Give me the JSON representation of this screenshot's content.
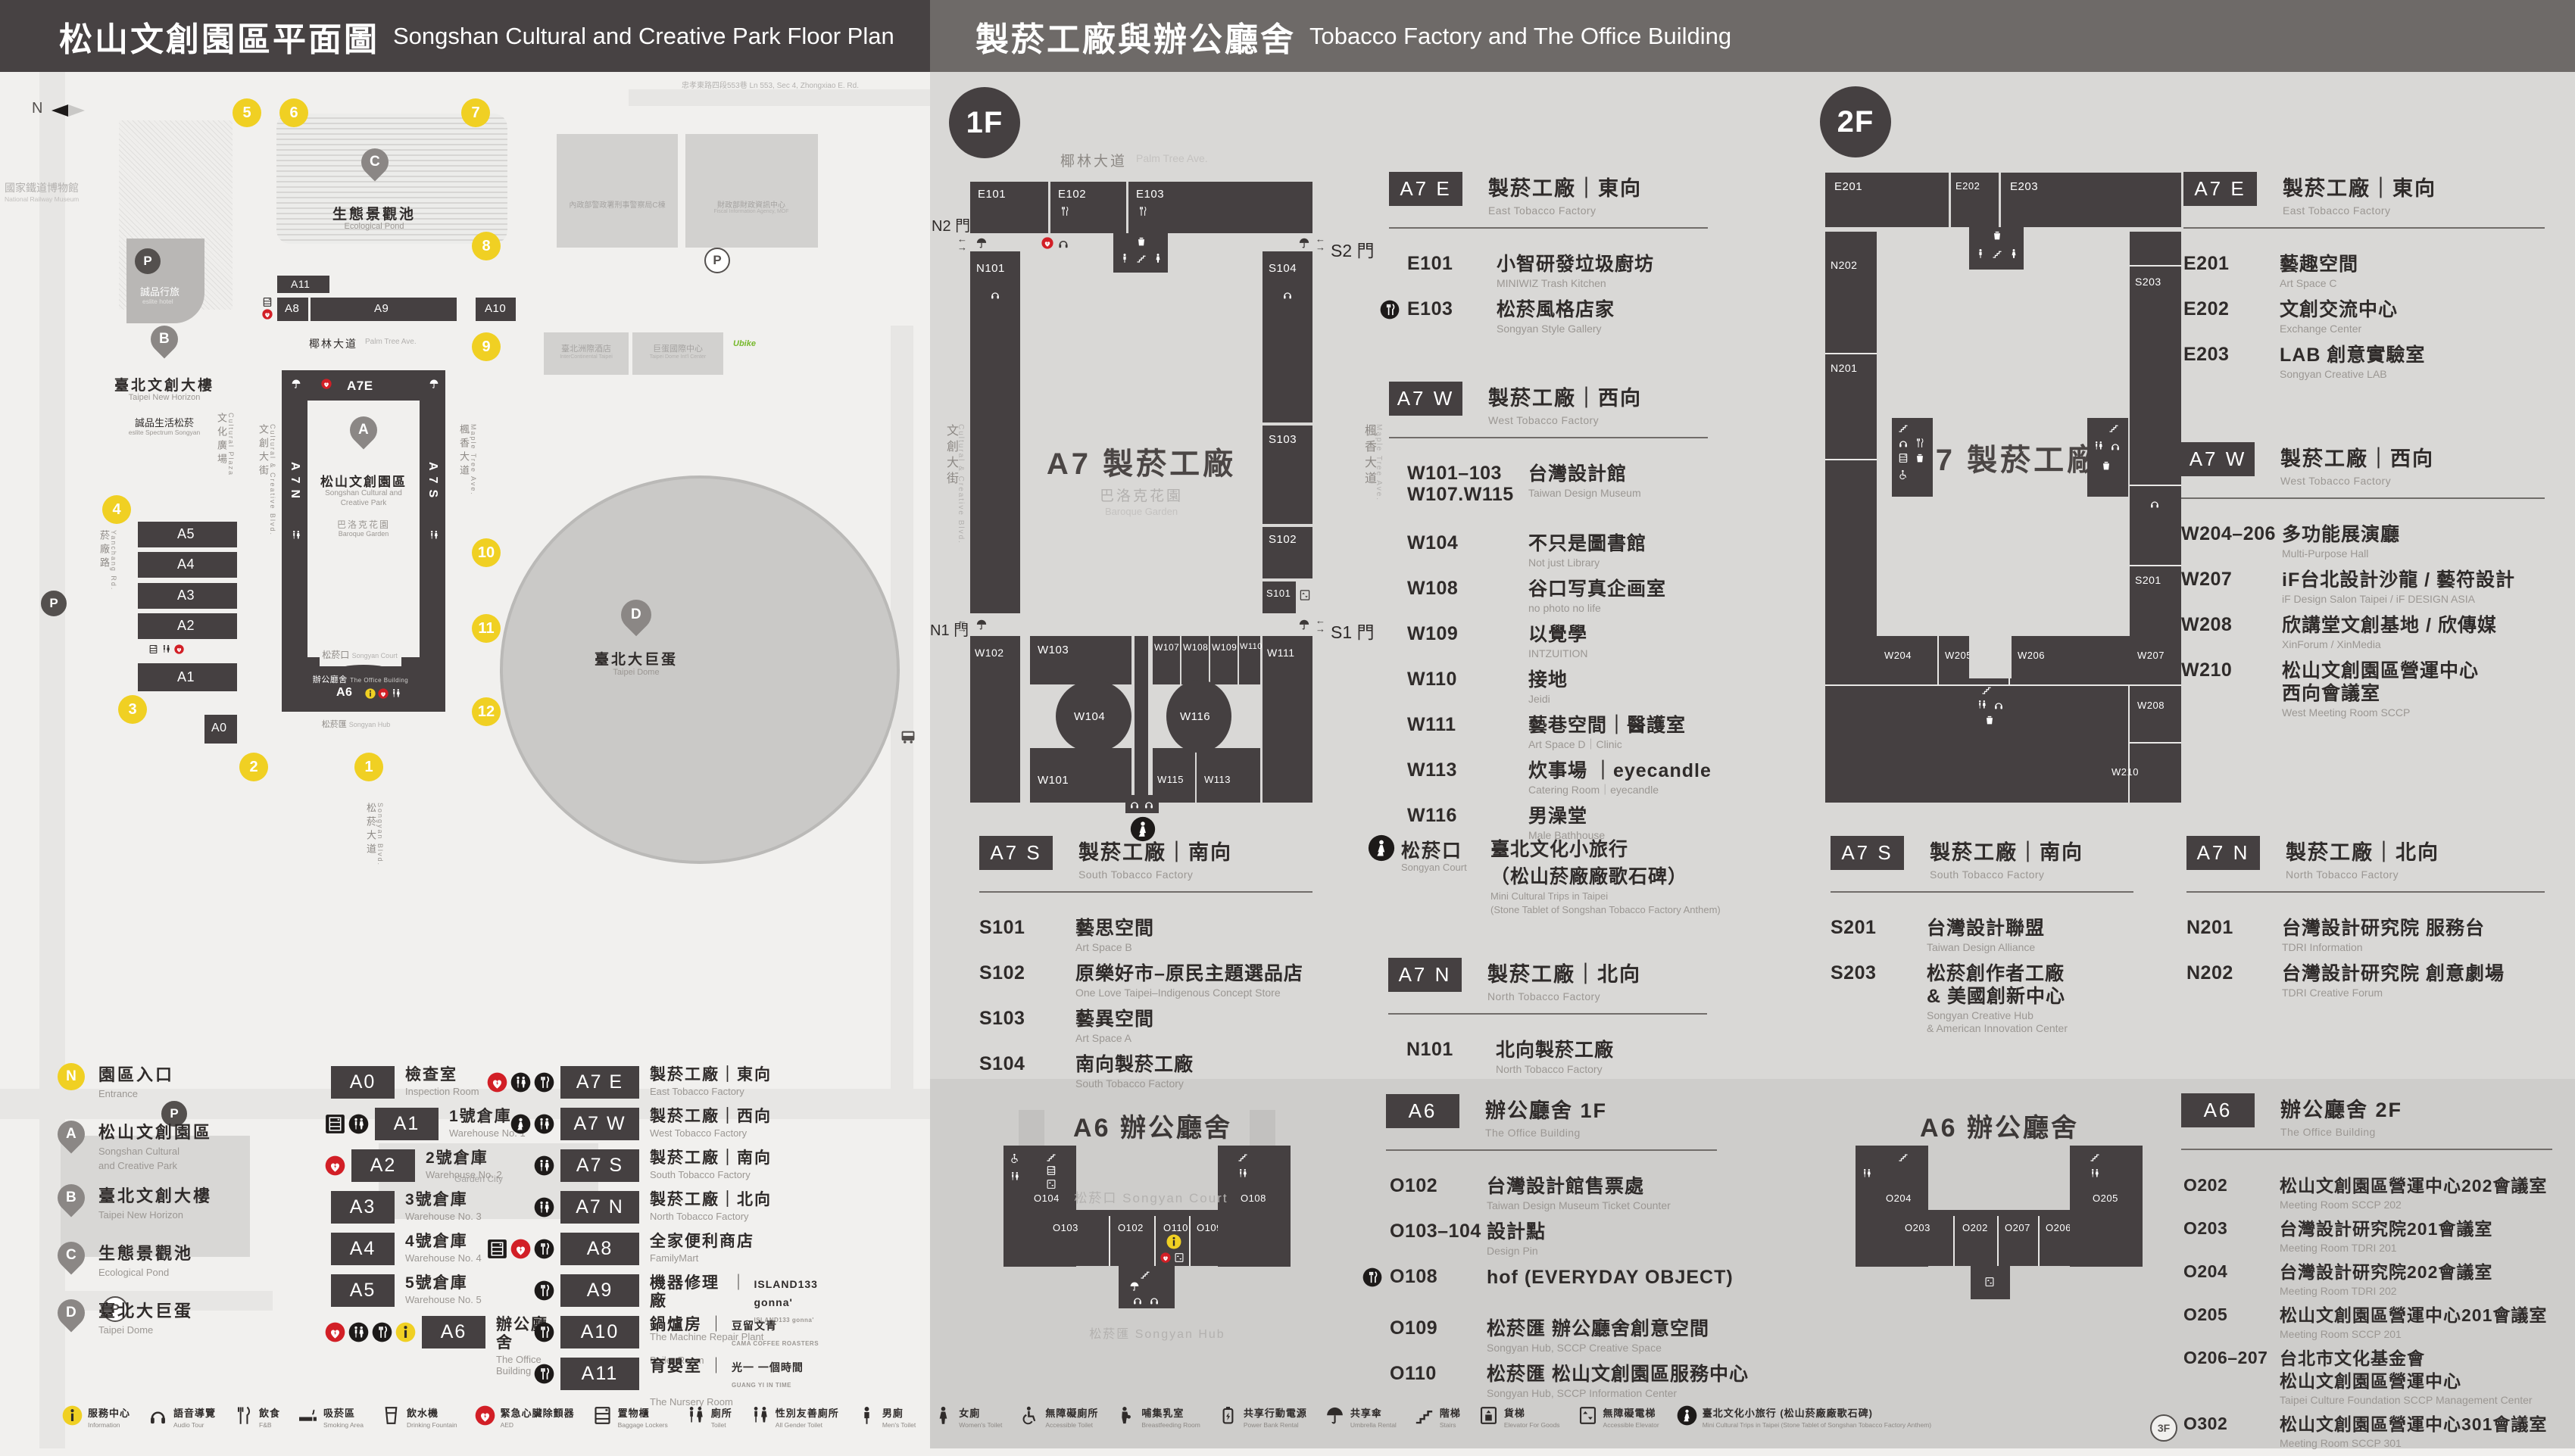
{
  "header": {
    "left": {
      "zh": "松山文創園區平面圖",
      "en": "Songshan Cultural and Creative Park Floor Plan"
    },
    "right": {
      "zh": "製菸工廠與辦公廳舍",
      "en": "Tobacco Factory and The Office Building"
    }
  },
  "floors": {
    "f1": "1F",
    "f2": "2F",
    "f3": "3F"
  },
  "park": {
    "compass": "N",
    "p_label": "P",
    "entrances": [
      "1",
      "2",
      "3",
      "4",
      "5",
      "6",
      "7",
      "8",
      "9",
      "10",
      "11",
      "12"
    ],
    "pins": {
      "a": "A",
      "b": "B",
      "c": "C",
      "d": "D"
    },
    "b": {
      "a11": "A11",
      "a8": "A8",
      "a9": "A9",
      "a10": "A10",
      "a7e": "A7E",
      "a7n": "A7N",
      "a7s": "A7S",
      "a7w": "A7W",
      "a5": "A5",
      "a4": "A4",
      "a3": "A3",
      "a2": "A2",
      "a1": "A1",
      "a0": "A0",
      "a6": "A6"
    },
    "labels": {
      "railway_zh": "國家鐵道博物館",
      "railway_en": "National Railway Museum",
      "eslite_hotel_zh": "誠品行旅",
      "eslite_hotel_en": "eslite hotel",
      "new_horizon_zh": "臺北文創大樓",
      "new_horizon_en": "Taipei New Horizon",
      "eslite_spectrum_zh": "誠品生活松菸",
      "eslite_spectrum_en": "eslite Spectrum Songyan",
      "pond_zh": "生態景觀池",
      "pond_en": "Ecological Pond",
      "palm_zh": "椰林大道",
      "palm_en": "Palm Tree Ave.",
      "cultural_plaza_zh": "文化廣場",
      "cultural_plaza_en": "Cultural Plaza",
      "creative_blvd_zh": "文創大街",
      "creative_blvd_en": "Cultural & Creative Blvd.",
      "maple_zh": "楓香大道",
      "maple_en": "Maple Tree Ave.",
      "yanchang_zh": "菸廠路",
      "yanchang_en": "Yanchang Rd.",
      "songyan_blvd_zh": "松菸大道",
      "songyan_blvd_en": "Songyan Blvd.",
      "zhongxiao": "忠孝東路四段553巷  Ln 553, Sec 4, Zhongxiao E. Rd.",
      "park_zh": "松山文創園區",
      "park_en1": "Songshan Cultural and",
      "park_en2": "Creative Park",
      "baroque_zh": "巴洛克花園",
      "baroque_en": "Baroque Garden",
      "court_zh": "松菸口",
      "court_en": "Songyan Court",
      "office_zh": "辦公廳舍",
      "office_en": "The Office Building",
      "hub_zh": "松菸匯",
      "hub_en": "Songyan Hub",
      "dome_zh": "臺北大巨蛋",
      "dome_en": "Taipei Dome",
      "icc_zh": "臺北洲際酒店",
      "icc_en": "InterContinental Taipei",
      "domectr_zh": "巨蛋國際中心",
      "domectr_en": "Taipei Dome Int'l Center",
      "npa_zh": "內政部警政署刑事警察局C棟",
      "fia_zh": "財政部財政資訊中心",
      "fia_en": "Fiscal Information Agency, MOF",
      "garden_city": "Garden City",
      "ubike": "Ubike"
    }
  },
  "map1": {
    "center": "A7 製菸工廠",
    "baroque_zh": "巴洛克花園",
    "baroque_en": "Baroque Garden",
    "gates": {
      "n2": "N2 門",
      "s2": "S2 門",
      "n1": "N1 門",
      "s1": "S1 門"
    },
    "rooms": {
      "e101": "E101",
      "e102": "E102",
      "e103": "E103",
      "n101": "N101",
      "s104": "S104",
      "s103": "S103",
      "s102": "S102",
      "s101": "S101",
      "w111": "W111",
      "w102": "W102",
      "w103": "W103",
      "w104": "W104",
      "w101": "W101",
      "w107": "W107",
      "w108": "W108",
      "w109": "W109",
      "w110": "W110",
      "w116": "W116",
      "w115": "W115",
      "w113": "W113"
    }
  },
  "map2": {
    "center": "A7 製菸工廠",
    "rooms": {
      "e201": "E201",
      "e202": "E202",
      "e203": "E203",
      "n202": "N202",
      "n201": "N201",
      "s203": "S203",
      "s201": "S201",
      "w204": "W204",
      "w205": "W205",
      "w206": "W206",
      "w207": "W207",
      "w208": "W208",
      "w210": "W210"
    }
  },
  "a6map1": {
    "title": "A6 辦公廳舍",
    "court": "松菸口 Songyan Court",
    "hub": "松菸匯 Songyan Hub",
    "rooms": {
      "o104": "O104",
      "o103": "O103",
      "o102": "O102",
      "o110": "O110",
      "o109": "O109",
      "o108": "O108"
    }
  },
  "a6map2": {
    "title": "A6 辦公廳舍",
    "rooms": {
      "o204": "O204",
      "o203": "O203",
      "o202": "O202",
      "o207": "O207",
      "o206": "O206",
      "o205": "O205"
    }
  },
  "sections": {
    "f1_a7e": {
      "badge": "A7 E",
      "zh": "製菸工廠｜東向",
      "en": "East Tobacco Factory",
      "rooms": [
        {
          "code": "E101",
          "zh": "小智研發垃圾廚坊",
          "en": "MINIWIZ Trash Kitchen"
        },
        {
          "code": "E103",
          "zh": "松菸風格店家",
          "en": "Songyan Style Gallery",
          "icons": [
            "fork-c"
          ]
        }
      ]
    },
    "f1_a7w": {
      "badge": "A7 W",
      "zh": "製菸工廠｜西向",
      "en": "West Tobacco Factory",
      "rooms": [
        {
          "code": "W101–103",
          "code2": "W107.W115",
          "zh": "台灣設計館",
          "en": "Taiwan Design Museum",
          "space": true
        },
        {
          "code": "W104",
          "zh": "不只是圖書館",
          "en": "Not just Library"
        },
        {
          "code": "W108",
          "zh": "谷口写真企画室",
          "en": "no photo no life"
        },
        {
          "code": "W109",
          "zh": "以覺學",
          "en": "INTZUITION"
        },
        {
          "code": "W110",
          "zh": "接地",
          "en": "Jeidi"
        },
        {
          "code": "W111",
          "zh": "藝巷空間｜醫護室",
          "en": "Art Space D｜Clinic"
        },
        {
          "code": "W113",
          "zh": "炊事場 ｜eyecandle",
          "en": "Catering Room｜eyecandle"
        },
        {
          "code": "W116",
          "zh": "男澡堂",
          "en": "Male Bathhouse"
        }
      ]
    },
    "f1_a7s": {
      "badge": "A7 S",
      "zh": "製菸工廠｜南向",
      "en": "South Tobacco Factory",
      "rooms": [
        {
          "code": "S101",
          "zh": "藝思空間",
          "en": "Art Space B"
        },
        {
          "code": "S102",
          "zh": "原樂好市–原民主題選品店",
          "en": "One Love Taipei–Indigenous Concept Store"
        },
        {
          "code": "S103",
          "zh": "藝異空間",
          "en": "Art Space A"
        },
        {
          "code": "S104",
          "zh": "南向製菸工廠",
          "en": "South Tobacco Factory"
        }
      ]
    },
    "f1_court": {
      "zh": "松菸口",
      "en": "Songyan Court",
      "l1": "臺北文化小旅行",
      "l2": "（松山菸廠廠歌石碑）",
      "e1": "Mini Cultural Trips in Taipei",
      "e2": "(Stone Tablet of Songshan Tobacco Factory Anthem)"
    },
    "f1_a7n": {
      "badge": "A7 N",
      "zh": "製菸工廠｜北向",
      "en": "North Tobacco Factory",
      "rooms": [
        {
          "code": "N101",
          "zh": "北向製菸工廠",
          "en": "North Tobacco Factory"
        }
      ]
    },
    "f1_a6": {
      "badge": "A6",
      "zh": "辦公廳舍 1F",
      "en": "The Office Building",
      "rooms": [
        {
          "code": "O102",
          "zh": "台灣設計館售票處",
          "en": "Taiwan Design Museum Ticket Counter"
        },
        {
          "code": "O103–104",
          "zh": "設計點",
          "en": "Design Pin"
        },
        {
          "code": "O108",
          "zh": "hof (EVERYDAY OBJECT)",
          "en": "",
          "icons": [
            "fork-c"
          ],
          "space": true
        },
        {
          "code": "O109",
          "zh": "松菸匯 辦公廳舍創意空間",
          "en": "Songyan Hub, SCCP Creative Space"
        },
        {
          "code": "O110",
          "zh": "松菸匯 松山文創園區服務中心",
          "en": "Songyan Hub, SCCP Information Center"
        }
      ]
    },
    "f2_a7e": {
      "badge": "A7 E",
      "zh": "製菸工廠｜東向",
      "en": "East Tobacco Factory",
      "rooms": [
        {
          "code": "E201",
          "zh": "藝趣空間",
          "en": "Art Space C"
        },
        {
          "code": "E202",
          "zh": "文創交流中心",
          "en": "Exchange Center"
        },
        {
          "code": "E203",
          "zh": "LAB 創意實驗室",
          "en": "Songyan Creative LAB"
        }
      ]
    },
    "f2_a7w": {
      "badge": "A7 W",
      "zh": "製菸工廠｜西向",
      "en": "West Tobacco Factory",
      "rooms": [
        {
          "code": "W204–206",
          "zh": "多功能展演廳",
          "en": "Multi-Purpose Hall"
        },
        {
          "code": "W207",
          "zh": "iF台北設計沙龍 / 藝符設計",
          "en": "iF Design Salon Taipei / iF DESIGN ASIA"
        },
        {
          "code": "W208",
          "zh": "欣講堂文創基地 / 欣傳媒",
          "en": "XinForum / XinMedia"
        },
        {
          "code": "W210",
          "zh": "松山文創園區營運中心",
          "zh2": "西向會議室",
          "en": "West Meeting Room SCCP"
        }
      ]
    },
    "f2_a7s": {
      "badge": "A7 S",
      "zh": "製菸工廠｜南向",
      "en": "South Tobacco Factory",
      "rooms": [
        {
          "code": "S201",
          "zh": "台灣設計聯盟",
          "en": "Taiwan Design Alliance"
        },
        {
          "code": "S203",
          "zh": "松菸創作者工廠",
          "zh2": "& 美國創新中心",
          "en": "Songyan Creative Hub",
          "en2": "& American Innovation Center"
        }
      ]
    },
    "f2_a7n": {
      "badge": "A7 N",
      "zh": "製菸工廠｜北向",
      "en": "North Tobacco Factory",
      "rooms": [
        {
          "code": "N201",
          "zh": "台灣設計研究院 服務台",
          "en": "TDRI Information"
        },
        {
          "code": "N202",
          "zh": "台灣設計研究院 創意劇場",
          "en": "TDRI Creative Forum"
        }
      ]
    },
    "f2_a6": {
      "badge": "A6",
      "zh": "辦公廳舍 2F",
      "en": "The Office Building",
      "rooms": [
        {
          "code": "O202",
          "zh": "松山文創園區營運中心202會議室",
          "en": "Meeting Room SCCP 202"
        },
        {
          "code": "O203",
          "zh": "台灣設計研究院201會議室",
          "en": "Meeting Room TDRI 201"
        },
        {
          "code": "O204",
          "zh": "台灣設計研究院202會議室",
          "en": "Meeting Room TDRI 202"
        },
        {
          "code": "O205",
          "zh": "松山文創園區營運中心201會議室",
          "en": "Meeting Room SCCP 201"
        },
        {
          "code": "O206–207",
          "zh": "台北市文化基金會",
          "zh2": "松山文創園區營運中心",
          "en": "Taipei Culture Foundation SCCP Management Center"
        },
        {
          "code": "O302",
          "prefix": "3F",
          "zh": "松山文創園區營運中心301會議室",
          "en": "Meeting Room SCCP 301"
        }
      ]
    }
  },
  "legend": {
    "places": [
      {
        "key": "N",
        "cls": "entr",
        "zh": "園區入口",
        "en": "Entrance"
      },
      {
        "key": "A",
        "zh": "松山文創園區",
        "en": "Songshan Cultural",
        "en2": "and Creative Park"
      },
      {
        "key": "B",
        "zh": "臺北文創大樓",
        "en": "Taipei New Horizon"
      },
      {
        "key": "C",
        "zh": "生態景觀池",
        "en": "Ecological Pond"
      },
      {
        "key": "D",
        "zh": "臺北大巨蛋",
        "en": "Taipei Dome"
      }
    ],
    "col1": [
      {
        "badge": "A0",
        "zh": "檢查室",
        "en": "Inspection Room"
      },
      {
        "badge": "A1",
        "zh": "1號倉庫",
        "en": "Warehouse No. 1",
        "icons": [
          "locker-c",
          "toilet-c"
        ]
      },
      {
        "badge": "A2",
        "zh": "2號倉庫",
        "en": "Warehouse No. 2",
        "icons": [
          "aed"
        ]
      },
      {
        "badge": "A3",
        "zh": "3號倉庫",
        "en": "Warehouse No. 3"
      },
      {
        "badge": "A4",
        "zh": "4號倉庫",
        "en": "Warehouse No. 4"
      },
      {
        "badge": "A5",
        "zh": "5號倉庫",
        "en": "Warehouse No. 5"
      },
      {
        "badge": "A6",
        "zh": "辦公廳舍",
        "en": "The Office Building",
        "icons": [
          "aed",
          "toilet-c",
          "fork-c",
          "info"
        ]
      }
    ],
    "col2": [
      {
        "badge": "A7 E",
        "zh": "製菸工廠｜東向",
        "en": "East Tobacco Factory",
        "icons": [
          "aed",
          "toilet-c",
          "fork-c"
        ]
      },
      {
        "badge": "A7 W",
        "zh": "製菸工廠｜西向",
        "en": "West Tobacco Factory",
        "icons": [
          "court",
          "toilet-c"
        ]
      },
      {
        "badge": "A7 S",
        "zh": "製菸工廠｜南向",
        "en": "South Tobacco Factory",
        "icons": [
          "toilet-c"
        ]
      },
      {
        "badge": "A7 N",
        "zh": "製菸工廠｜北向",
        "en": "North Tobacco Factory",
        "icons": [
          "toilet-c"
        ]
      },
      {
        "badge": "A8",
        "zh": "全家便利商店",
        "en": "FamilyMart",
        "icons": [
          "locker-c",
          "aed",
          "fork-c"
        ]
      },
      {
        "badge": "A9",
        "zh": "機器修理廠",
        "en": "The Machine Repair Plant",
        "sep": "｜",
        "brand": "ISLAND133 gonna'",
        "brand_sub": "ISLAND133 gonna'",
        "icons": [
          "fork-c"
        ]
      },
      {
        "badge": "A10",
        "zh": "鍋爐房",
        "en": "Boiler Room",
        "sep": "｜",
        "brand": "豆留文青",
        "brand_sub": "CAMA COFFEE ROASTERS",
        "icons": [
          "fork-c"
        ]
      },
      {
        "badge": "A11",
        "zh": "育嬰室",
        "en": "The Nursery Room",
        "sep": "｜",
        "brand": "光一 一個時間",
        "brand_sub": "GUANG YI IN TIME",
        "icons": [
          "fork-c"
        ]
      }
    ]
  },
  "facilities": [
    {
      "icon": "info",
      "zh": "服務中心",
      "en": "Information"
    },
    {
      "icon": "headphone",
      "zh": "語音導覽",
      "en": "Audio Tour"
    },
    {
      "icon": "fork",
      "zh": "飲食",
      "en": "F&B"
    },
    {
      "icon": "cigarette",
      "zh": "吸菸區",
      "en": "Smoking Area"
    },
    {
      "icon": "cup",
      "zh": "飲水機",
      "en": "Drinking Fountain"
    },
    {
      "icon": "aed",
      "zh": "緊急心臟除顫器",
      "en": "AED"
    },
    {
      "icon": "locker",
      "zh": "置物櫃",
      "en": "Baggage Lockers"
    },
    {
      "icon": "toilet",
      "zh": "廁所",
      "en": "Toilet"
    },
    {
      "icon": "allgender",
      "zh": "性別友善廁所",
      "en": "All Gender Toilet"
    },
    {
      "icon": "man",
      "zh": "男廁",
      "en": "Men's Toilet"
    },
    {
      "icon": "woman",
      "zh": "女廁",
      "en": "Women's Toilet"
    },
    {
      "icon": "wheelchair",
      "zh": "無障礙廁所",
      "en": "Accessible Toilet"
    },
    {
      "icon": "breastfeeding",
      "zh": "哺集乳室",
      "en": "Breastfeeding Room"
    },
    {
      "icon": "powerbank",
      "zh": "共享行動電源",
      "en": "Power Bank Rental"
    },
    {
      "icon": "umbrella",
      "zh": "共享傘",
      "en": "Umbrella Rental"
    },
    {
      "icon": "stairs",
      "zh": "階梯",
      "en": "Stairs"
    },
    {
      "icon": "goodslift",
      "zh": "貨梯",
      "en": "Elevator For Goods"
    },
    {
      "icon": "lift",
      "zh": "無障礙電梯",
      "en": "Accessible Elevator"
    },
    {
      "icon": "court",
      "zh": "臺北文化小旅行 (松山菸廠廠歌石碑)",
      "en": "Mini Cultural Trips in Taipei (Stone Tablet of Songshan Tobacco Factory Anthem)"
    }
  ]
}
